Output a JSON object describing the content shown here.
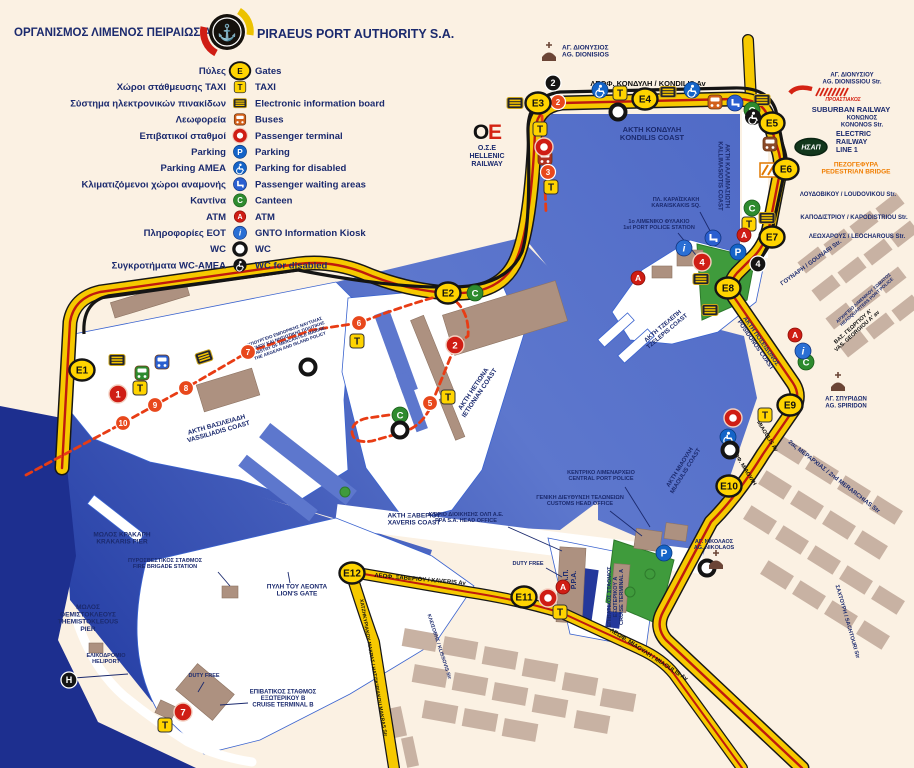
{
  "header": {
    "title_gr": "ΟΡΓΑΝΙΣΜΟΣ ΛΙΜΕΝΟΣ ΠΕΙΡΑΙΩΣ Α.Ε.",
    "title_en": "PIRAEUS PORT AUTHORITY S.A."
  },
  "colors": {
    "navy": "#1b2a6e",
    "black": "#111111",
    "orange": "#f07d00",
    "red": "#d42313",
    "white": "#ffffff",
    "sea_deep": "#22399f",
    "road_yellow": "#f6c900",
    "road_red": "#bf1a0e",
    "land_cream": "#fbf1e3",
    "green": "#3f9b3c"
  },
  "legend": {
    "rows": [
      {
        "gr": "Πύλες",
        "icon": "gate",
        "en": "Gates"
      },
      {
        "gr": "Χώροι στάθμευσης TAXI",
        "icon": "taxi",
        "en": "TAXI"
      },
      {
        "gr": "Σύστημα ηλεκτρονικών πινακίδων",
        "icon": "board",
        "en": "Electronic information board"
      },
      {
        "gr": "Λεωφορεία",
        "icon": "bus",
        "en": "Buses"
      },
      {
        "gr": "Επιβατικοί σταθμοί",
        "icon": "terminal",
        "en": "Passenger terminal"
      },
      {
        "gr": "Parking",
        "icon": "parking",
        "en": "Parking"
      },
      {
        "gr": "Parking ΑΜΕΑ",
        "icon": "disabled",
        "en": "Parking for disabled"
      },
      {
        "gr": "Κλιματιζόμενοι χώροι αναμονής",
        "icon": "waiting",
        "en": "Passenger waiting areas"
      },
      {
        "gr": "Καντίνα",
        "icon": "canteen",
        "en": "Canteen"
      },
      {
        "gr": "ATM",
        "icon": "atm",
        "en": "ATM"
      },
      {
        "gr": "Πληροφορίες ΕΟΤ",
        "icon": "info",
        "en": "GNTO Information Kiosk"
      },
      {
        "gr": "WC",
        "icon": "wc",
        "en": "WC"
      },
      {
        "gr": "Συγκροτήματα WC-ΑΜΕΑ",
        "icon": "wcdis",
        "en": "WC for disabled"
      }
    ]
  },
  "map": {
    "gates": [
      {
        "id": "E1",
        "x": 82,
        "y": 370
      },
      {
        "id": "E2",
        "x": 448,
        "y": 293
      },
      {
        "id": "E3",
        "x": 538,
        "y": 103
      },
      {
        "id": "E4",
        "x": 645,
        "y": 99
      },
      {
        "id": "E5",
        "x": 772,
        "y": 123
      },
      {
        "id": "E6",
        "x": 786,
        "y": 169
      },
      {
        "id": "E7",
        "x": 772,
        "y": 237
      },
      {
        "id": "E8",
        "x": 728,
        "y": 288
      },
      {
        "id": "E9",
        "x": 790,
        "y": 405
      },
      {
        "id": "E10",
        "x": 729,
        "y": 486
      },
      {
        "id": "E11",
        "x": 524,
        "y": 597
      },
      {
        "id": "E12",
        "x": 352,
        "y": 573
      }
    ],
    "stops": [
      {
        "n": "2",
        "x": 558,
        "y": 102
      },
      {
        "n": "3",
        "x": 548,
        "y": 172
      },
      {
        "n": "5",
        "x": 430,
        "y": 403
      },
      {
        "n": "6",
        "x": 359,
        "y": 323
      },
      {
        "n": "7",
        "x": 248,
        "y": 352
      },
      {
        "n": "8",
        "x": 186,
        "y": 388
      },
      {
        "n": "9",
        "x": 155,
        "y": 405
      },
      {
        "n": "10",
        "x": 123,
        "y": 423
      }
    ],
    "stations": [
      {
        "n": "2",
        "x": 553,
        "y": 83
      },
      {
        "n": "4",
        "x": 758,
        "y": 264
      },
      {
        "n": "H",
        "x": 69,
        "y": 680
      }
    ],
    "terminals": [
      {
        "n": "1",
        "x": 118,
        "y": 394
      },
      {
        "n": "2",
        "x": 455,
        "y": 345
      },
      {
        "n": "",
        "x": 544,
        "y": 147
      },
      {
        "n": "4",
        "x": 702,
        "y": 262
      },
      {
        "n": "",
        "x": 733,
        "y": 418
      },
      {
        "n": "",
        "x": 548,
        "y": 598
      },
      {
        "n": "7",
        "x": 183,
        "y": 712
      }
    ],
    "icons": [
      {
        "t": "board",
        "x": 515,
        "y": 103
      },
      {
        "t": "board",
        "x": 668,
        "y": 92
      },
      {
        "t": "board",
        "x": 762,
        "y": 100
      },
      {
        "t": "board",
        "x": 767,
        "y": 218
      },
      {
        "t": "board",
        "x": 701,
        "y": 279
      },
      {
        "t": "board",
        "x": 710,
        "y": 310
      },
      {
        "t": "board",
        "x": 117,
        "y": 360
      },
      {
        "t": "board",
        "x": 204,
        "y": 357,
        "r": -18
      },
      {
        "t": "taxi",
        "x": 620,
        "y": 93
      },
      {
        "t": "taxi",
        "x": 540,
        "y": 129
      },
      {
        "t": "taxi",
        "x": 551,
        "y": 187
      },
      {
        "t": "taxi",
        "x": 749,
        "y": 224
      },
      {
        "t": "taxi",
        "x": 140,
        "y": 388
      },
      {
        "t": "taxi",
        "x": 357,
        "y": 341
      },
      {
        "t": "taxi",
        "x": 448,
        "y": 397
      },
      {
        "t": "taxi",
        "x": 765,
        "y": 415
      },
      {
        "t": "taxi",
        "x": 560,
        "y": 612
      },
      {
        "t": "taxi",
        "x": 165,
        "y": 725
      },
      {
        "t": "bus",
        "x": 715,
        "y": 102,
        "c": "#d2601a"
      },
      {
        "t": "bus",
        "x": 142,
        "y": 373,
        "c": "#2e8b2e"
      },
      {
        "t": "bus",
        "x": 162,
        "y": 362,
        "c": "#2a5fd0"
      },
      {
        "t": "bus",
        "x": 770,
        "y": 144,
        "c": "#8a4a2a"
      },
      {
        "t": "bus",
        "x": 545,
        "y": 158,
        "c": "#b03020"
      },
      {
        "t": "waiting",
        "x": 735,
        "y": 103
      },
      {
        "t": "waiting",
        "x": 713,
        "y": 238
      },
      {
        "t": "parking",
        "x": 738,
        "y": 252
      },
      {
        "t": "parking",
        "x": 664,
        "y": 553
      },
      {
        "t": "disabled",
        "x": 600,
        "y": 90
      },
      {
        "t": "disabled",
        "x": 692,
        "y": 90
      },
      {
        "t": "disabled",
        "x": 728,
        "y": 437
      },
      {
        "t": "canteen",
        "x": 752,
        "y": 110
      },
      {
        "t": "canteen",
        "x": 752,
        "y": 208
      },
      {
        "t": "canteen",
        "x": 475,
        "y": 293
      },
      {
        "t": "canteen",
        "x": 400,
        "y": 415
      },
      {
        "t": "canteen",
        "x": 806,
        "y": 362
      },
      {
        "t": "atm",
        "x": 744,
        "y": 235
      },
      {
        "t": "atm",
        "x": 638,
        "y": 278
      },
      {
        "t": "atm",
        "x": 563,
        "y": 587
      },
      {
        "t": "atm",
        "x": 795,
        "y": 335
      },
      {
        "t": "info",
        "x": 684,
        "y": 248
      },
      {
        "t": "info",
        "x": 803,
        "y": 351
      },
      {
        "t": "wc",
        "x": 618,
        "y": 112
      },
      {
        "t": "wc",
        "x": 308,
        "y": 367
      },
      {
        "t": "wc",
        "x": 400,
        "y": 430
      },
      {
        "t": "wc",
        "x": 730,
        "y": 450
      },
      {
        "t": "wc",
        "x": 707,
        "y": 568
      },
      {
        "t": "wcdis",
        "x": 753,
        "y": 117
      },
      {
        "t": "church",
        "x": 549,
        "y": 57
      },
      {
        "t": "church",
        "x": 838,
        "y": 387
      },
      {
        "t": "church",
        "x": 716,
        "y": 565
      }
    ],
    "logos": {
      "hsap_text": "ΗΣΑΠ"
    },
    "labels": [
      {
        "n": "ag-dionisios",
        "t": "ΑΓ. ΔΙΟΝΥΣΙΟΣ|AG. DIONISIOS",
        "x": 562,
        "y": 53,
        "s": 6.5,
        "a": "start"
      },
      {
        "n": "kondilis-av",
        "t": "ΛΕΩΦ. ΚΟΝΔΥΛΗ / KONDILIS Av",
        "x": 648,
        "y": 86,
        "s": 7.5,
        "c": "black"
      },
      {
        "n": "akti-kondili",
        "t": "ΑΚΤΗ ΚΟΝΔΥΛΗ|KONDILIS COAST",
        "x": 652,
        "y": 136,
        "s": 7.5
      },
      {
        "n": "ag-dionissiou-str",
        "t": "ΑΓ. ΔΙΟΝΥΣΙΟΥ|AG. DIONISSIOU Str.",
        "x": 852,
        "y": 80,
        "s": 6
      },
      {
        "n": "proastiakos",
        "t": "ΠΡΟΑΣΤΙΑΚΟΣ",
        "x": 843,
        "y": 101,
        "s": 5,
        "c": "red",
        "i": 1
      },
      {
        "n": "suburban-railway",
        "t": "SUBURBAN RAILWAY",
        "x": 851,
        "y": 112,
        "s": 7.5
      },
      {
        "n": "kononos-str",
        "t": "ΚΟΝΩΝΟΣ|KONONOS Str.",
        "x": 862,
        "y": 123,
        "s": 6
      },
      {
        "n": "electric-railway",
        "t": "ELECTRIC|RAILWAY|LINE 1",
        "x": 836,
        "y": 144,
        "s": 7,
        "a": "start"
      },
      {
        "n": "pedestrian-bridge",
        "t": "ΠΕΖΟΓΕΦΥΡΑ|PEDESTRIAN BRIDGE",
        "x": 856,
        "y": 170,
        "s": 6.5,
        "c": "orange"
      },
      {
        "n": "loudovikou-str",
        "t": "ΛΟΥΔΟΒΙΚΟΥ / LOUDOVIKOU Str.",
        "x": 848,
        "y": 196,
        "s": 6
      },
      {
        "n": "kapodistriou-str",
        "t": "ΚΑΠΟΔΙΣΤΡΙΟΥ / KAPODISTRIOU Str.",
        "x": 854,
        "y": 219,
        "s": 6
      },
      {
        "n": "leocharous-str",
        "t": "ΛΕΩΧΑΡΟΥΣ / LEOCHAROUS Str.",
        "x": 857,
        "y": 238,
        "s": 6
      },
      {
        "n": "gounari-str",
        "t": "ΓΟΥΝΑΡΗ / GOUNARI Str.",
        "x": 812,
        "y": 264,
        "s": 6,
        "r": -36
      },
      {
        "n": "port-police-hq",
        "t": "ΑΡΧΗΓΕΙΟ ΛΙΜΕΝΙΚΟΥ ΣΩΜΑΤΟΣ|HEADQUARTERS PORT POLICE",
        "x": 866,
        "y": 301,
        "s": 4.5,
        "r": -42
      },
      {
        "n": "vas-georgiou-av",
        "t": "ΒΑΣ. ΓΕΩΡΓΙΟΥ Α'|VAS. GEORGIOU A' av",
        "x": 856,
        "y": 330,
        "s": 5.5,
        "r": -42,
        "c": "black"
      },
      {
        "n": "ag-spiridon",
        "t": "ΑΓ. ΣΠΥΡΙΔΩΝ|AG. SPIRIDON",
        "x": 846,
        "y": 404,
        "s": 6
      },
      {
        "n": "akti-posidonos",
        "t": "ΑΚΤΗ ΠΟΣΕΙΔΩΝΟΣ|POSIDONOS COAST",
        "x": 757,
        "y": 344,
        "s": 6,
        "r": 55
      },
      {
        "n": "akti-kallimasioti",
        "t": "ΑΚΤΗ ΚΑΛΛΙΜΑΣΙΩΤΗ|KALLIMASIOTIS COAST",
        "x": 722,
        "y": 176,
        "s": 6,
        "r": 90
      },
      {
        "n": "karaiskaki-sq",
        "t": "ΠΛ. ΚΑΡΑΪΣΚΑΚΗ|KARAISKAKIS SQ.",
        "x": 676,
        "y": 204,
        "s": 5.5,
        "ld": [
          700,
          212,
          716,
          242
        ]
      },
      {
        "n": "port-police-station",
        "t": "1ο ΛΙΜΕΝΙΚΟ ΦΥΛΑΚΙΟ|1st PORT POLICE STATION",
        "x": 659,
        "y": 226,
        "s": 5.5,
        "ld": [
          678,
          233,
          700,
          260
        ]
      },
      {
        "n": "akti-tzelepi",
        "t": "ΑΚΤΗ ΤΖΕΛΕΠΗ|TZELEPIS COAST",
        "x": 666,
        "y": 330,
        "s": 6,
        "r": -40
      },
      {
        "n": "akti-miaouli",
        "t": "ΑΚΤΗ ΜΙΑΟΥΛΗ|MIAOULIS COAST",
        "x": 684,
        "y": 470,
        "s": 6,
        "r": -58
      },
      {
        "n": "merarchias-str",
        "t": "2ας ΜΕΡΑΡΧΙΑΣ / 2nd MERARCHIAS Str",
        "x": 833,
        "y": 478,
        "s": 6,
        "r": 38
      },
      {
        "n": "miaoulis-av-en",
        "t": "MIAOULIS Av",
        "x": 766,
        "y": 437,
        "s": 5.5,
        "c": "black",
        "r": 58
      },
      {
        "n": "miaoulis-av-gr",
        "t": "ΛΕΩΦ. ΜΙΑΟΥΛΗ",
        "x": 742,
        "y": 467,
        "s": 5.5,
        "c": "black",
        "r": 58
      },
      {
        "n": "ag-nikolaos",
        "t": "ΑΓ. ΝΙΚΟΛΑΟΣ|AG. NIKOLAOS",
        "x": 714,
        "y": 546,
        "s": 5.5
      },
      {
        "n": "sachtouri-str",
        "t": "ΣΑΧΤΟΥΡΗ / SACHTOURI Str",
        "x": 846,
        "y": 622,
        "s": 5.5,
        "r": 74
      },
      {
        "n": "central-port-police",
        "t": "ΚΕΝΤΡΙΚΟ ΛΙΜΕΝΑΡΧΕΙΟ|CENTRAL PORT POLICE",
        "x": 601,
        "y": 477,
        "s": 5.5,
        "ld": [
          625,
          487,
          650,
          527
        ]
      },
      {
        "n": "customs-head-office",
        "t": "ΓΕΝΙΚΗ ΔΙΕΥΘΥΝΣΗ ΤΕΛΩΝΕΙΩΝ|CUSTOMS HEAD OFFICE",
        "x": 580,
        "y": 502,
        "s": 5.5,
        "ld": [
          610,
          511,
          642,
          536
        ]
      },
      {
        "n": "ppa-head-office",
        "t": "ΚΤΙΡΙΟ ΔΙΟΙΚΗΣΗΣ ΟΛΠ Α.Ε.|PPA S.A. HEAD OFFICE",
        "x": 466,
        "y": 519,
        "s": 5.5,
        "ld": [
          508,
          527,
          562,
          551
        ]
      },
      {
        "n": "akti-xaveriou",
        "t": "ΑΚΤΗ ΞΑΒΕΡΙΟΥ|XAVERIS COAST",
        "x": 414,
        "y": 521,
        "s": 6.5
      },
      {
        "n": "olp-ppa",
        "t": "Ο.Λ.Π.|P.P.A.",
        "x": 572,
        "y": 580,
        "s": 7,
        "r": -90
      },
      {
        "n": "duty-free-a",
        "t": "DUTY FREE",
        "x": 528,
        "y": 565,
        "s": 5.5,
        "ld": [
          546,
          568,
          562,
          577
        ]
      },
      {
        "n": "cruise-terminal-a",
        "t": "ΕΠΙΒΑΤΙΚΟΣ ΣΤΑΘΜΟΣ|ΕΞΩΤΕΡΙΚΟΥ Α|CRUISE TERMINAL A",
        "x": 617,
        "y": 597,
        "s": 5.5,
        "r": -90
      },
      {
        "n": "xaveris-av",
        "t": "ΛΕΩΦ. ΞΑΒΕΡΙΟΥ / XAVERIS Av",
        "x": 420,
        "y": 581,
        "s": 6,
        "c": "black",
        "r": 5
      },
      {
        "n": "lions-gate",
        "t": "ΠΥΛΗ ΤΟΥ ΛΕΟΝΤΑ|LION'S GATE",
        "x": 297,
        "y": 592,
        "s": 6.5,
        "ld": [
          290,
          583,
          288,
          572
        ]
      },
      {
        "n": "hatzikiriakou-str",
        "t": "ΧΑΤΖΗΚΥΡΙΑΚΟΥ ΜΑΚΡΑΣ / HATZIKIRIAKOU MAKRAS Str",
        "x": 372,
        "y": 668,
        "s": 5,
        "c": "black",
        "r": 80
      },
      {
        "n": "klissovis-str",
        "t": "ΚΛΕΙΣΟΒΗΣ / KLISSOVIS Str",
        "x": 438,
        "y": 647,
        "s": 5,
        "r": 72
      },
      {
        "n": "miaoulis-av-lower",
        "t": "ΛΕΩΦ. ΜΙΑΟΥΛΗ / MIAOULIS Av",
        "x": 648,
        "y": 656,
        "s": 6,
        "c": "black",
        "r": 33
      },
      {
        "n": "krakaris-pier",
        "t": "ΜΩΛΟΣ ΚΡΑΚΑΡΗ|KRAKARIS PIER",
        "x": 122,
        "y": 540,
        "s": 6.5
      },
      {
        "n": "fire-brigade",
        "t": "ΠΥΡΟΣΒΕΣΤΙΚΟΣ ΣΤΑΘΜΟΣ|FIRE BRIGADE STATION",
        "x": 165,
        "y": 565,
        "s": 5.5,
        "ld": [
          218,
          572,
          230,
          586
        ]
      },
      {
        "n": "themistokleous-pier",
        "t": "ΜΩΛΟΣ|ΘΕΜΙΣΤΟΚΛΕΟΥΣ|THEMISTOKLEOUS|PIER",
        "x": 88,
        "y": 620,
        "s": 6.5
      },
      {
        "n": "heliport",
        "t": "ΕΛΙΚΟΔΡΟΜΙΟ|HELIPORT",
        "x": 106,
        "y": 660,
        "s": 5.5,
        "ld": [
          74,
          678,
          128,
          674
        ]
      },
      {
        "n": "duty-free-b",
        "t": "DUTY FREE",
        "x": 204,
        "y": 677,
        "s": 5.5,
        "ld": [
          204,
          682,
          198,
          692
        ]
      },
      {
        "n": "cruise-terminal-b",
        "t": "ΕΠΙΒΑΤΙΚΟΣ ΣΤΑΘΜΟΣ|ΕΞΩΤΕΡΙΚΟΥ Β|CRUISE TERMINAL B",
        "x": 283,
        "y": 700,
        "s": 6,
        "ld": [
          248,
          703,
          220,
          705
        ]
      },
      {
        "n": "akti-vassiliadi",
        "t": "ΑΚΤΗ ΒΑΣΙΛΕΙΑΔΗ|VASSILIADIS COAST",
        "x": 218,
        "y": 430,
        "s": 6.5,
        "r": -16
      },
      {
        "n": "akti-ietionia",
        "t": "ΑΚΤΗ ΗΕΤΙΩΝΑ|IETIONIAN COAST",
        "x": 478,
        "y": 392,
        "s": 6.5,
        "r": -56
      },
      {
        "n": "ministry-marine",
        "t": "ΥΠΟΥΡΓΕΙΟ ΕΜΠΟΡΙΚΗΣ ΝΑΥΤΙΛΙΑΣ|ΑΙΓΑΙΟΥ ΚΑΙ ΝΗΣΙΩΤΙΚΗΣ ΠΟΛΙΤΙΚΗΣ|MINISTRY OF MERCANTILE MARINE,|THE AEGEAN AND ISLAND POLICY",
        "x": 288,
        "y": 340,
        "s": 4.5,
        "r": -20
      },
      {
        "n": "ose-railway",
        "t": "Ο.Σ.Ε|HELLENIC|RAILWAY",
        "x": 487,
        "y": 158,
        "s": 7
      }
    ]
  }
}
